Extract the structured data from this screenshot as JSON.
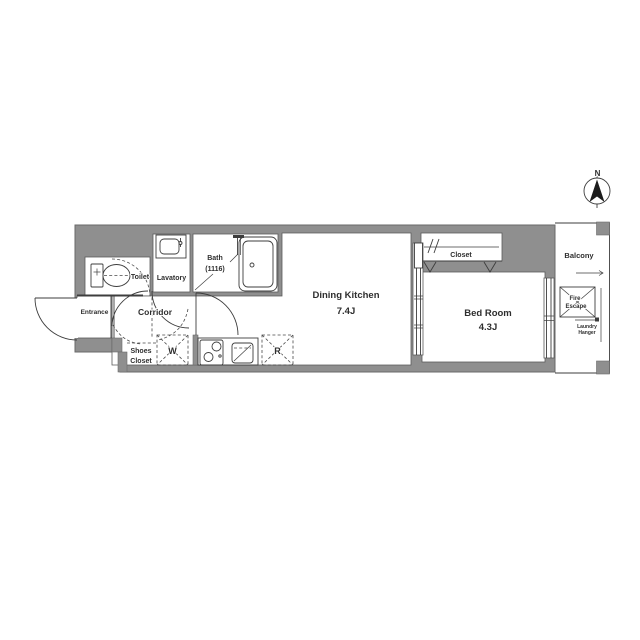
{
  "floor_plan": {
    "compass": {
      "north_label": "N"
    },
    "rooms": {
      "toilet": {
        "label": "Toilet"
      },
      "lavatory": {
        "label": "Lavatory"
      },
      "bath": {
        "label_line1": "Bath",
        "label_line2": "(1116)"
      },
      "entrance": {
        "label": "Entrance"
      },
      "corridor": {
        "label": "Corridor"
      },
      "shoes_closet": {
        "label_line1": "Shoes",
        "label_line2": "Closet"
      },
      "washer_space": {
        "label": "W"
      },
      "refrigerator_space": {
        "label": "R"
      },
      "dining_kitchen": {
        "label": "Dining Kitchen",
        "size": "7.4J"
      },
      "closet": {
        "label": "Closet"
      },
      "bedroom": {
        "label": "Bed Room",
        "size": "4.3J"
      },
      "balcony": {
        "label": "Balcony"
      },
      "fire_escape": {
        "label_line1": "Fire",
        "label_line2": "Escape"
      },
      "laundry_hanger": {
        "label_line1": "Laundry",
        "label_line2": "Hanger"
      }
    },
    "fixtures": [
      "toilet-icon",
      "sink-icon",
      "bathtub-icon",
      "stove-icon",
      "kitchen-sink-icon",
      "compass-icon",
      "door-swing-arc",
      "sliding-door"
    ],
    "colors": {
      "wall": "#8f8f8f",
      "line": "#3d3d3d",
      "text": "#2e2e2e",
      "background": "#ffffff"
    }
  }
}
